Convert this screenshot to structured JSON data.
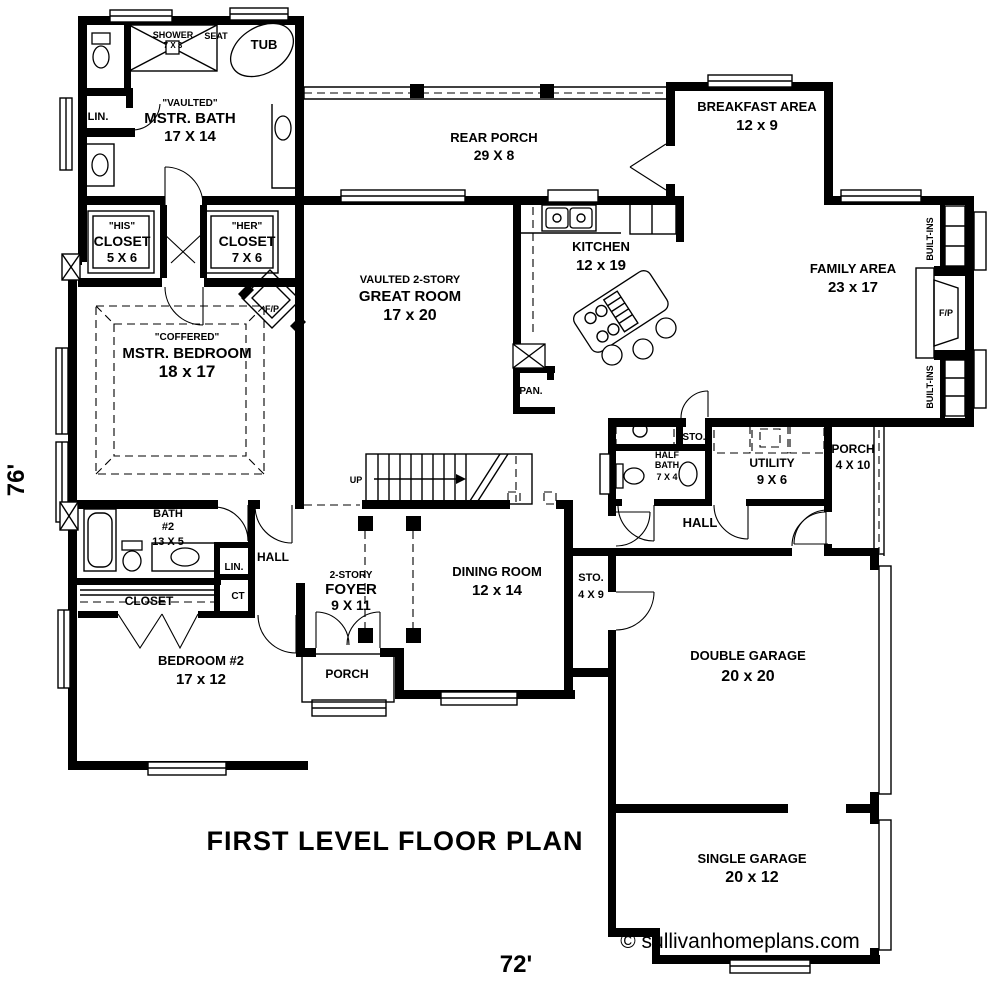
{
  "rooms": {
    "mstr_bath": {
      "lines": [
        "\"VAULTED\"",
        "MSTR. BATH",
        "17 X 14"
      ]
    },
    "shower": {
      "lines": [
        "SHOWER",
        "7 X 3"
      ]
    },
    "seat": {
      "lines": [
        "SEAT"
      ]
    },
    "tub": {
      "lines": [
        "TUB"
      ]
    },
    "lin1": {
      "lines": [
        "LIN."
      ]
    },
    "his_closet": {
      "lines": [
        "\"HIS\"",
        "CLOSET",
        "5 X 6"
      ]
    },
    "her_closet": {
      "lines": [
        "\"HER\"",
        "CLOSET",
        "7 X 6"
      ]
    },
    "mstr_bedroom": {
      "lines": [
        "\"COFFERED\"",
        "MSTR. BEDROOM",
        "18 x 17"
      ]
    },
    "fp1": {
      "lines": [
        "F/P"
      ]
    },
    "rear_porch": {
      "lines": [
        "REAR PORCH",
        "29 X 8"
      ]
    },
    "great_room": {
      "lines": [
        "VAULTED 2-STORY",
        "GREAT ROOM",
        "17 x 20"
      ]
    },
    "kitchen": {
      "lines": [
        "KITCHEN",
        "12 x 19"
      ]
    },
    "pan": {
      "lines": [
        "PAN."
      ]
    },
    "breakfast": {
      "lines": [
        "BREAKFAST AREA",
        "12 x 9"
      ]
    },
    "family": {
      "lines": [
        "FAMILY AREA",
        "23 x 17"
      ]
    },
    "built_ins_top": {
      "lines": [
        "BUILT-INS"
      ]
    },
    "built_ins_bottom": {
      "lines": [
        "BUILT-INS"
      ]
    },
    "fp2": {
      "lines": [
        "F/P"
      ]
    },
    "sto1": {
      "lines": [
        "STO."
      ]
    },
    "half_bath": {
      "lines": [
        "HALF",
        "BATH",
        "7 X 4"
      ]
    },
    "utility": {
      "lines": [
        "UTILITY",
        "9 X 6"
      ]
    },
    "porch_right": {
      "lines": [
        "PORCH",
        "4 X 10"
      ]
    },
    "hall_right": {
      "lines": [
        "HALL"
      ]
    },
    "up": {
      "lines": [
        "UP"
      ]
    },
    "foyer": {
      "lines": [
        "2-STORY",
        "FOYER",
        "9 X 11"
      ]
    },
    "dining": {
      "lines": [
        "DINING ROOM",
        "12 x 14"
      ]
    },
    "sto2": {
      "lines": [
        "STO.",
        "4 X 9"
      ]
    },
    "porch_front": {
      "lines": [
        "PORCH"
      ]
    },
    "bath2": {
      "lines": [
        "BATH",
        "#2",
        "13 X 5"
      ]
    },
    "lin2": {
      "lines": [
        "LIN."
      ]
    },
    "ct": {
      "lines": [
        "CT"
      ]
    },
    "hall_left": {
      "lines": [
        "HALL"
      ]
    },
    "closet2": {
      "lines": [
        "CLOSET"
      ]
    },
    "bedroom2": {
      "lines": [
        "BEDROOM #2",
        "17 x 12"
      ]
    },
    "double_garage": {
      "lines": [
        "DOUBLE GARAGE",
        "20 x 20"
      ]
    },
    "single_garage": {
      "lines": [
        "SINGLE GARAGE",
        "20 x 12"
      ]
    }
  },
  "annotations": {
    "title": "FIRST LEVEL FLOOR PLAN",
    "width_dim": "72'",
    "height_dim": "76'",
    "copyright": "© sullivanhomeplans.com"
  }
}
